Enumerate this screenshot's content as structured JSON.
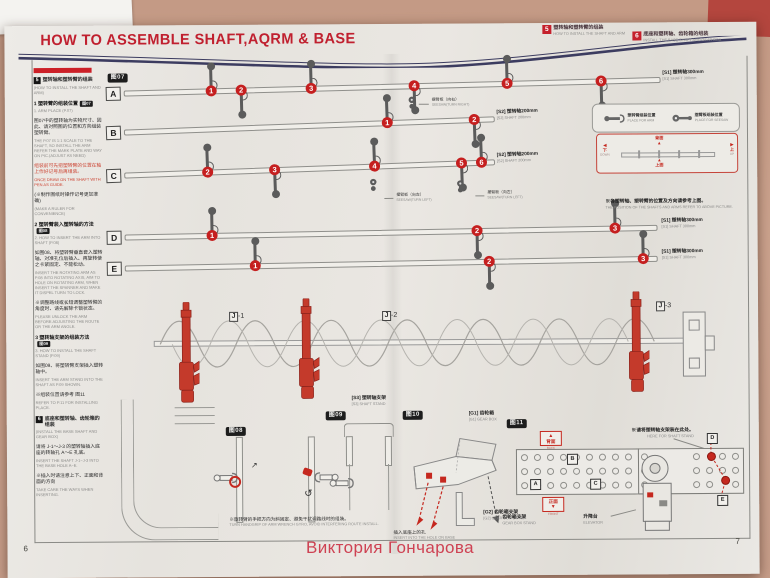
{
  "photo": {
    "watermark": "Виктория Гончарова"
  },
  "page": {
    "title": "HOW TO ASSEMBLE SHAFT,AQRM & BASE",
    "left_number": "6",
    "right_number": "7"
  },
  "colors": {
    "accent_red": "#c0202f",
    "rule_navy": "#3c3c60",
    "part_red": "#c43a2b",
    "badge_red": "#c51f1f"
  },
  "step_headers": [
    {
      "num": "5",
      "zh": "塑转轴和塑转臂的组装",
      "en": "HOW TO INSTALL THE SHAFT AND ARM"
    },
    {
      "num": "6",
      "zh": "底座和塑转轴、齿轮箱的组装",
      "en": "INSTALL THE BASE SHAFT AND GEAR BOX"
    }
  ],
  "left_panel": {
    "blocks": [
      {
        "type": "sec",
        "num": "5",
        "zh": "塑转轴和塑转臂的组装",
        "en": "(HOW TO INSTALL THE SHAFT AND ARM)"
      },
      {
        "type": "step",
        "zh": "1 塑转臂的组装位置",
        "fig": "图07",
        "en": "1. ARM PLACE (P.07)"
      },
      {
        "type": "body",
        "zh": "图07中的塑转轴为实物尺寸、因此、请对照图的位置和方向组装塑转臂。",
        "en": "THE P.07 IS 1:1 SCALE TO THE SHAFT, SO INSTALL THE ARM REFER THE MARK PLATE AND WAY ON PIC.(ADJUST AS NEED)"
      },
      {
        "type": "red",
        "zh": "组装前可先把塑转臂的位置在轴上作好记号后再组装。",
        "en": "ONCE DRAW ON THE SHAFT WITH PEN AS GUIDE."
      },
      {
        "type": "note",
        "zh": "(※制作图纸时操作记号更加准确)",
        "en": "(MAKE A RULER FOR CONVENIENCE)"
      },
      {
        "type": "step",
        "zh": "2 塑转臂装入塑转轴的方法",
        "fig": "图08",
        "en": "2. HOW TO INSERT THE ARM INTO SHAFT (P.08)"
      },
      {
        "type": "body",
        "zh": "如图08、将塑转臂垂直套入塑转轴、对准孔位后插入、再旋转使之卡紧固定、不能松动。",
        "en": "INSERT THE ROTATING ARM AS P.08 INTO ROTATING AXIS, AIM TO HOLE ON ROTATING ARM, WHEN INSERT THE SPANNER AND MAKE IT DISPEL TURN TO LOCK."
      },
      {
        "type": "note",
        "zh": "※调整路线或长短调整塑转臂的角度时、请先解除卡锁状态。",
        "en": "PLEASE UNLOCK THE ARM BEFORE ADJUSTING THE ROUTE OR THE ARM ANGLE."
      },
      {
        "type": "step",
        "zh": "3 塑转轴支架的组装方法",
        "fig": "图09",
        "en": "3. HOW TO INSTALL THE SHAFT STAND (P.09)"
      },
      {
        "type": "body",
        "zh": "如图09、将塑转臂支架插入塑转轴中。",
        "en": "INSERT THE ARM STAND INTO THE SHAFT AS P.09 SHOWN."
      },
      {
        "type": "note",
        "zh": "※组装位置请参考 图11",
        "en": "REFER TO P.11 FOR INSTALLING PLACE."
      },
      {
        "type": "sec",
        "num": "6",
        "zh": "底座和塑转轴、齿轮箱的组装",
        "en": "(INSTALL THE BASE SHAFT AND GEAR BOX)"
      },
      {
        "type": "body",
        "zh": "请将 J-1～J-3 的塑转轴插入底座的转轴孔 A～E 孔底。",
        "en": "INSERT THE SHAFT J-1~J-3 INTO THE BASE HOLE A~E."
      },
      {
        "type": "note",
        "zh": "※插入时请注意上下、正面和背面的方向",
        "en": "TAKE CARE THE WAYS WHEN INSERTING."
      }
    ]
  },
  "diagram": {
    "fig_label": "图07",
    "rows": [
      {
        "letter": "A",
        "marks": [
          "1",
          "2",
          "3",
          "4",
          "5",
          "6"
        ],
        "label_zh": "[S1] 塑转轴300mm",
        "label_en": "[S1] SHAFT 300mm"
      },
      {
        "letter": "B",
        "marks": [
          "1",
          "2"
        ],
        "label_zh": "[S2] 塑转轴200mm",
        "label_en": "[S2] SHAFT 200mm"
      },
      {
        "letter": "C",
        "marks": [
          "2",
          "3",
          "4",
          "5",
          "6"
        ],
        "label_zh": "[S2] 塑转轴200mm",
        "label_en": "[S2] SHAFT 200mm"
      },
      {
        "letter": "D",
        "marks": [
          "1",
          "2",
          "3"
        ],
        "label_zh": "[S1] 塑转轴300mm",
        "label_en": "[S1] SHAFT 300mm"
      },
      {
        "letter": "E",
        "marks": [
          "1",
          "2",
          "3"
        ],
        "label_zh": "[S1] 塑转轴300mm",
        "label_en": "[S1] SHAFT 300mm"
      }
    ],
    "seesaw_right": {
      "zh": "摆臂板（向右）",
      "en": "SEESAW(TURN RIGHT)"
    },
    "seesaw_left": {
      "zh": "摆臂板（向左）",
      "en": "SEESAW(TURN LEFT)"
    },
    "position_note_zh": "※各塑转轴、塑转臂的位置及方向请参考上图。",
    "position_note_en": "THE POSITION OF THE SHAFTS AND ARMS REFER TO ABOVE PICTURE.",
    "place_box": {
      "arm_zh": "塑转臂组装位置",
      "arm_en": "PLACE FOR ARM",
      "seesaw_zh": "摆臂板组装位置",
      "seesaw_en": "PLACE FOR SEESAW"
    },
    "orient_box": {
      "down_zh": "下",
      "down_en": "DOWN",
      "up_zh": "上",
      "up_en": "UP",
      "back_zh": "背面",
      "back_en": "BACK",
      "front_zh": "上面",
      "front_en": "FRONT"
    }
  },
  "assembly": {
    "j_letter": "J",
    "units": [
      "-1",
      "-2",
      "-3"
    ]
  },
  "fig08": {
    "label": "图08",
    "caption_zh": "※旋转臂的手把方向为斜固定、避免干扰调路线时的组装。",
    "caption_en": "TURN HANDGRIP OF ARM WRENCH GYRO, AVOID INTERFERING ROUTE INSTALL."
  },
  "fig09": {
    "label": "图09",
    "part_zh": "[S3] 塑转轴支架",
    "part_en": "[S3] SHAFT STAND"
  },
  "fig10": {
    "label": "图10",
    "gearbox_zh": "[G1] 齿轮箱",
    "gearbox_en": "[G1] GEAR BOX",
    "insert_zh": "插入底座上的孔",
    "insert_en": "INSERT INTO THE HOLE ON BASE",
    "stand_zh": "[G2] 齿轮箱支架",
    "stand_en": "[G2] GEAR BOX STAND"
  },
  "fig11": {
    "label": "图11",
    "here_zh": "※请将塑转轴支架装在此处。",
    "here_en": "HERE FOR SHAFT STAND",
    "back_zh": "背面",
    "back_en": "BACK",
    "front_zh": "正面",
    "front_en": "FRONT",
    "gearstand_zh": "齿轮箱支架",
    "gearstand_en": "GEAR BOX STAND",
    "elevator_zh": "升降台",
    "elevator_en": "ELEVATOR",
    "letters": [
      "A",
      "B",
      "C",
      "D",
      "E"
    ]
  }
}
